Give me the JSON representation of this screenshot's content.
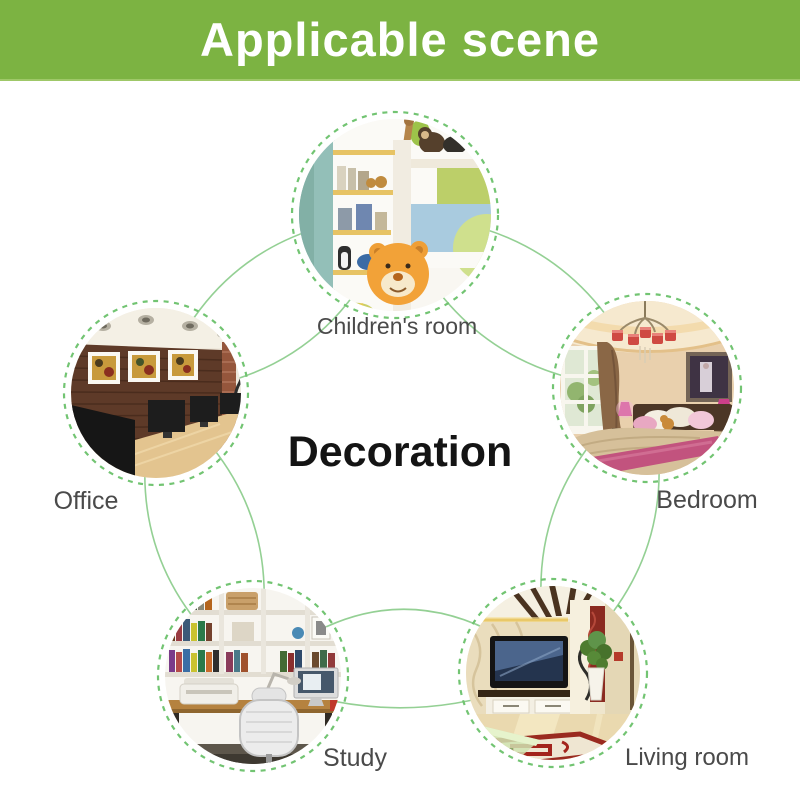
{
  "header": {
    "title": "Applicable scene",
    "background_color": "#7cb342",
    "text_color": "#ffffff"
  },
  "diagram": {
    "center_label": "Decoration",
    "scenes": [
      {
        "id": "children-room",
        "label": "Children's room"
      },
      {
        "id": "office",
        "label": "Office"
      },
      {
        "id": "bedroom",
        "label": "Bedroom"
      },
      {
        "id": "study",
        "label": "Study"
      },
      {
        "id": "living-room",
        "label": "Living room"
      }
    ],
    "colors": {
      "dashed_circle": "#72c472",
      "connector_line": "#94d094",
      "label_text": "#4a4a4a",
      "center_text": "#141414"
    }
  }
}
